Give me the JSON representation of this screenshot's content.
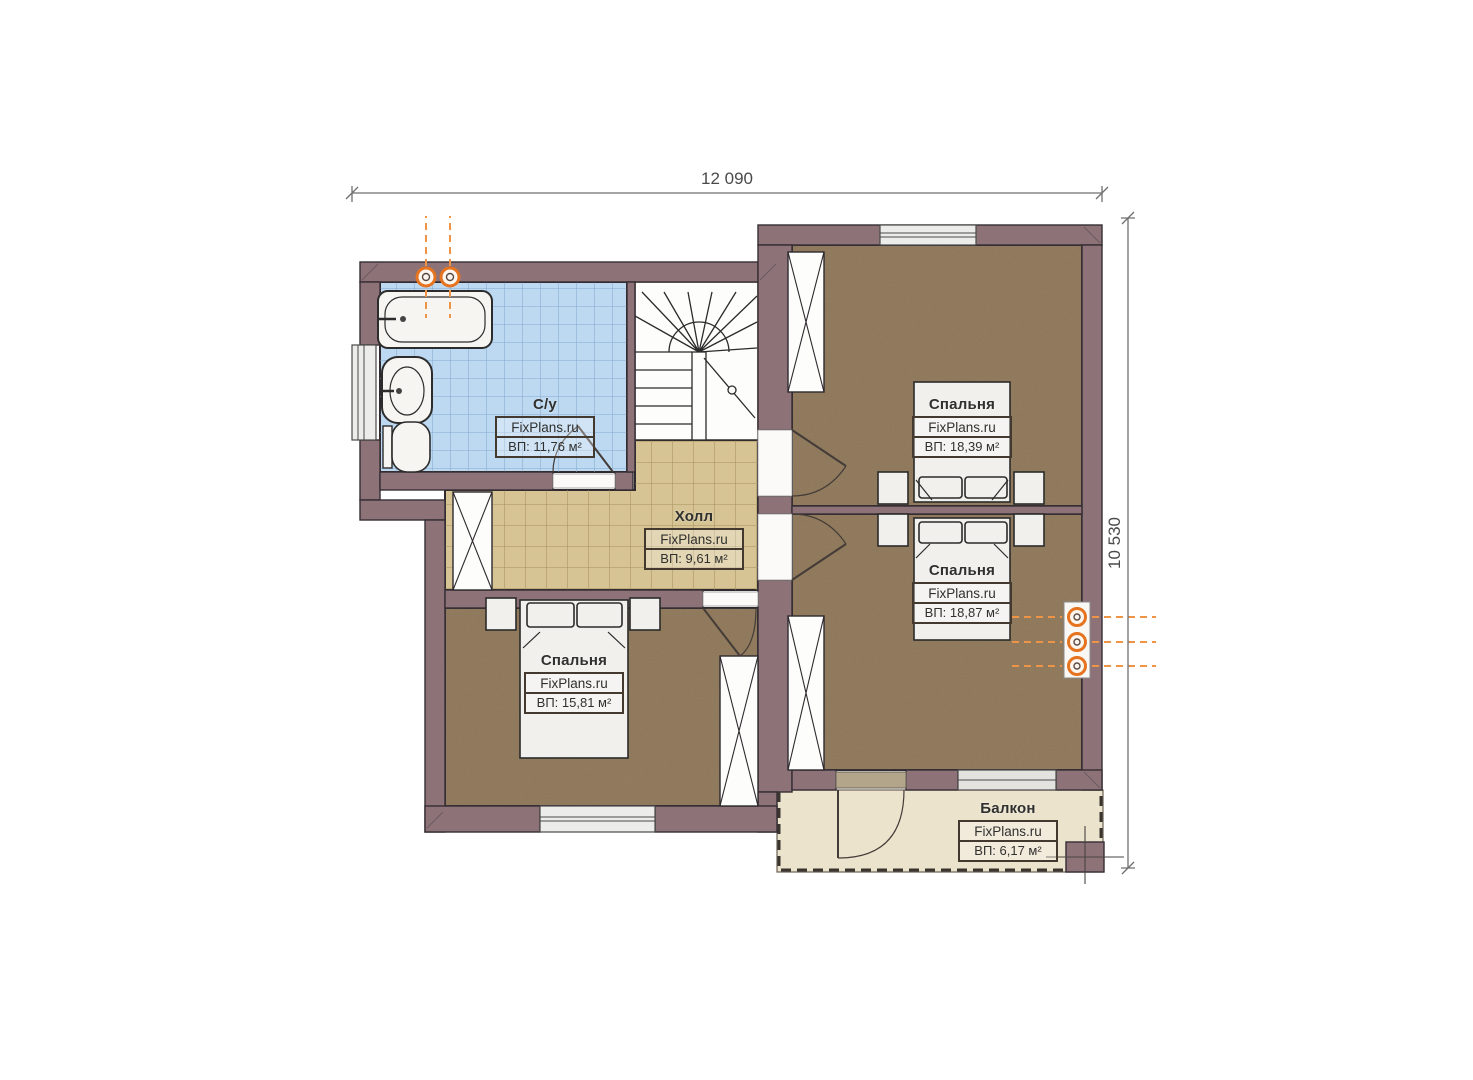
{
  "title": "Floor plan — second floor",
  "dimensions": {
    "width_label": "12 090",
    "height_label": "10 530"
  },
  "rooms": [
    {
      "id": "bathroom",
      "name": "С/у",
      "brand": "FixPlans.ru",
      "area": "ВП: 11,76 м²"
    },
    {
      "id": "hall",
      "name": "Холл",
      "brand": "FixPlans.ru",
      "area": "ВП: 9,61 м²"
    },
    {
      "id": "bedroom-top-right",
      "name": "Спальня",
      "brand": "FixPlans.ru",
      "area": "ВП: 18,39 м²"
    },
    {
      "id": "bedroom-mid-right",
      "name": "Спальня",
      "brand": "FixPlans.ru",
      "area": "ВП: 18,87 м²"
    },
    {
      "id": "bedroom-left",
      "name": "Спальня",
      "brand": "FixPlans.ru",
      "area": "ВП: 15,81 м²"
    },
    {
      "id": "balcony",
      "name": "Балкон",
      "brand": "FixPlans.ru",
      "area": "ВП: 6,17 м²"
    }
  ],
  "colors": {
    "wall": "#8d7378",
    "bathroom_tile": "#bdd9f1",
    "hall_tile": "#d6c494",
    "bedroom_floor": "#8d7556",
    "balcony_floor": "#ece3cd",
    "furniture": "#f1f0ec",
    "accent_orange": "#e5731f",
    "outline": "#352d33"
  }
}
